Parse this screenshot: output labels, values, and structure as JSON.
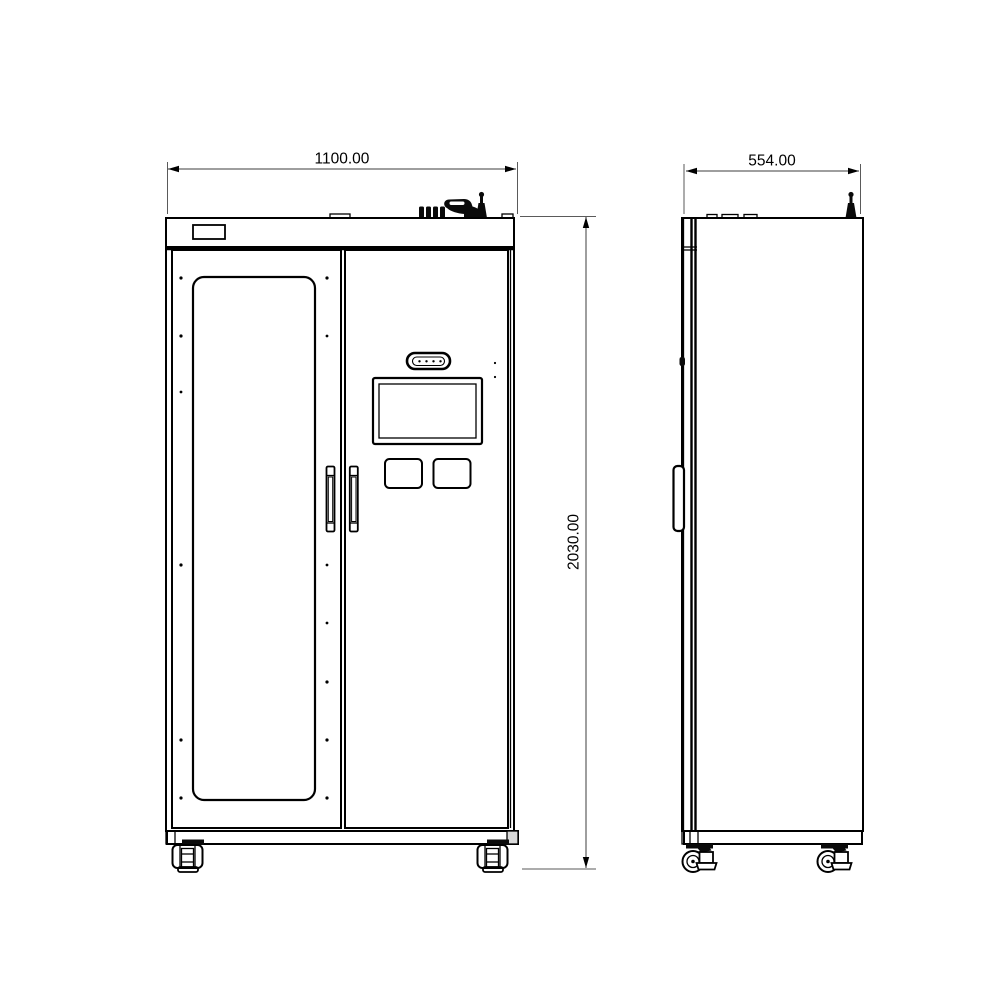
{
  "colors": {
    "background": "#ffffff",
    "line": "#000000",
    "dimension_line": "#3c3c3c",
    "text": "#000000"
  },
  "dimensions": {
    "width": {
      "label": "1100.00"
    },
    "depth": {
      "label": "554.00"
    },
    "height": {
      "label": "2030.00"
    }
  }
}
